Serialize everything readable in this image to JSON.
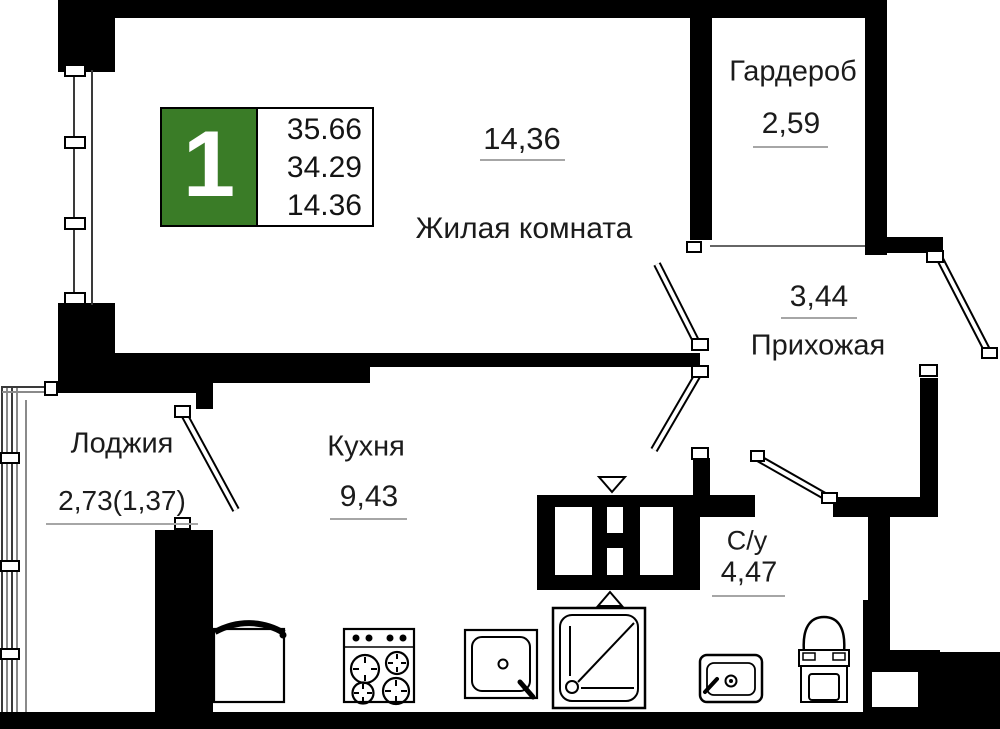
{
  "badge": {
    "rooms_count": "1",
    "lines": [
      "35.66",
      "34.29",
      "14.36"
    ]
  },
  "rooms": {
    "living": {
      "name": "Жилая комната",
      "area": "14,36"
    },
    "wardrobe": {
      "name": "Гардероб",
      "area": "2,59"
    },
    "hallway": {
      "name": "Прихожая",
      "area": "3,44"
    },
    "kitchen": {
      "name": "Кухня",
      "area": "9,43"
    },
    "loggia": {
      "name": "Лоджия",
      "area": "2,73(1,37)"
    },
    "bathroom": {
      "name": "С/у",
      "area": "4,47"
    }
  },
  "colors": {
    "wall": "#000000",
    "badge_green": "#3a7c27",
    "underline": "#a6a6a6",
    "text": "#1b1b1b"
  }
}
